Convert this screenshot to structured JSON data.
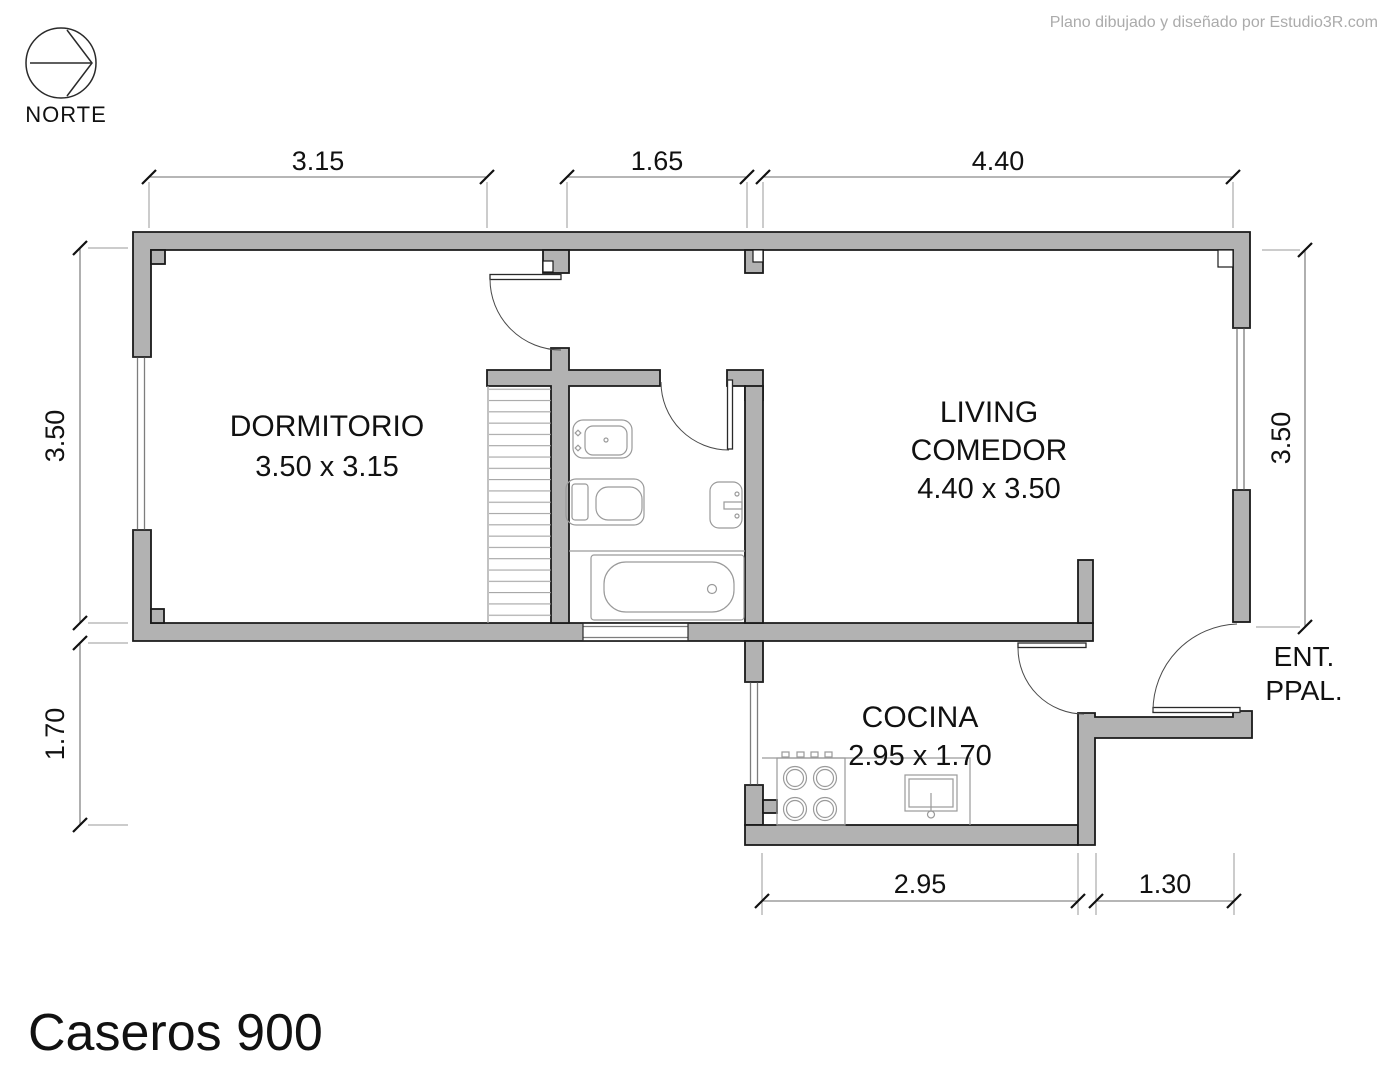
{
  "credit": "Plano dibujado y diseñado por Estudio3R.com",
  "title": "Caseros 900",
  "north": {
    "label": "NORTE"
  },
  "entrance": {
    "line1": "ENT.",
    "line2": "PPAL."
  },
  "rooms": {
    "dormitorio": {
      "name": "DORMITORIO",
      "size": "3.50 x 3.15"
    },
    "living": {
      "name_line1": "LIVING",
      "name_line2": "COMEDOR",
      "size": "4.40 x 3.50"
    },
    "cocina": {
      "name": "COCINA",
      "size": "2.95 x 1.70"
    }
  },
  "dimensions": {
    "top": [
      "3.15",
      "1.65",
      "4.40"
    ],
    "left": [
      "3.50",
      "1.70"
    ],
    "right": [
      "3.50"
    ],
    "bottom": [
      "2.95",
      "1.30"
    ]
  },
  "colors": {
    "wall_fill": "#b2b2b2",
    "wall_stroke": "#1a1a1a",
    "dimension_line": "#6e6e6e",
    "fixture_line": "#9a9a9a",
    "credit_text": "#ababab",
    "text": "#111111",
    "background": "#ffffff"
  }
}
